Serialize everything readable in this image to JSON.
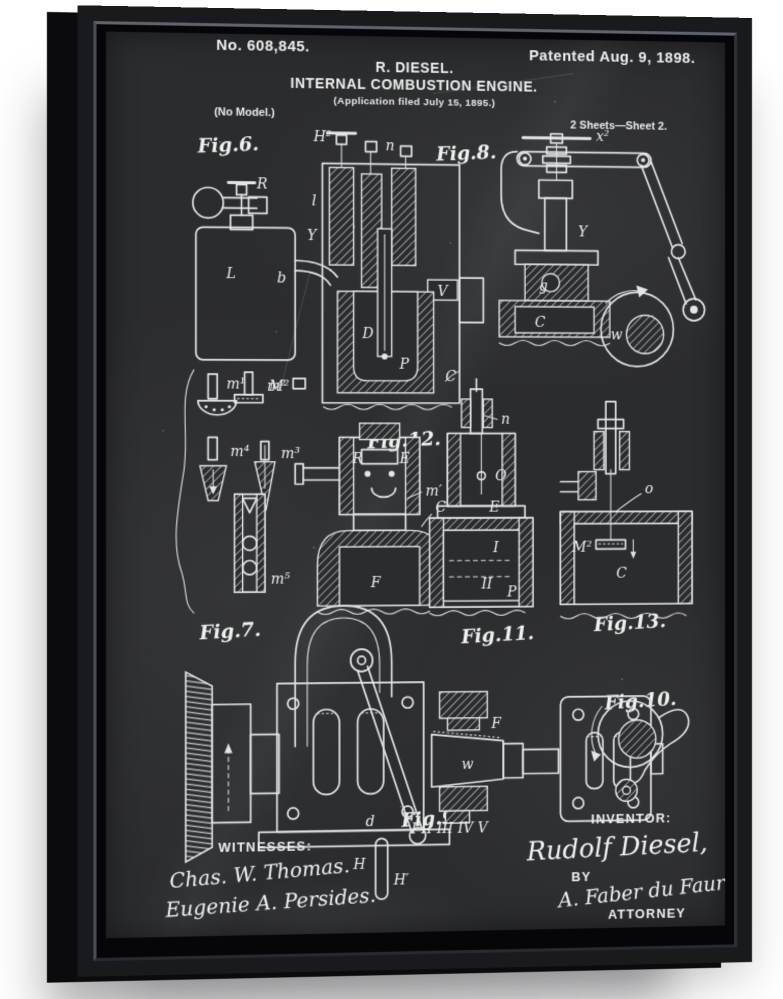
{
  "colors": {
    "background": "#ffffff",
    "frame": "#191a1e",
    "frame_side": "#0b0b0d",
    "chalkboard": "#2b2c2e",
    "chalk": "#e8eaea"
  },
  "patent": {
    "number": "No. 608,845.",
    "date": "Patented Aug. 9, 1898.",
    "inventor_name": "R. DIESEL.",
    "title": "INTERNAL COMBUSTION ENGINE.",
    "application": "(Application filed July 15, 1895.)",
    "model_note": "(No Model.)",
    "sheet_note": "2 Sheets—Sheet 2.",
    "figures": {
      "fig6": {
        "label": "Fig.6.",
        "parts": {
          "R": "R",
          "L": "L",
          "b": "b",
          "S": "S",
          "l": "l",
          "H2": "H²",
          "n": "n",
          "Y": "Y",
          "V": "V",
          "D": "D",
          "P": "P",
          "C": "C",
          "M2": "M²"
        }
      },
      "fig8": {
        "label": "Fig.8.",
        "parts": {
          "x2": "x²",
          "Y": "Y",
          "g": "g",
          "C": "C",
          "w": "w"
        }
      },
      "fig7": {
        "label": "Fig.7.",
        "parts": {
          "m1": "m¹",
          "m2": "m²",
          "m3": "m³",
          "m4": "m⁴",
          "m5": "m⁵"
        }
      },
      "fig12": {
        "label": "Fig.12.",
        "parts": {
          "R": "R",
          "E": "E",
          "m_prime": "m′",
          "C": "C",
          "F": "F"
        }
      },
      "fig11": {
        "label": "Fig.11.",
        "parts": {
          "n": "n",
          "O": "O",
          "E": "E",
          "I": "I",
          "II": "II",
          "P": "P"
        }
      },
      "fig13": {
        "label": "Fig.13.",
        "parts": {
          "o": "o",
          "M2": "M²",
          "C": "C"
        }
      },
      "fig9": {
        "label": "Fig.9.",
        "parts": {
          "d": "d",
          "H": "H",
          "H_prime": "H′",
          "F": "F",
          "w": "w",
          "numerals": "I II III IV V"
        }
      },
      "fig10": {
        "label": "Fig.10."
      }
    },
    "witnesses": {
      "heading": "WITNESSES:",
      "signatures": [
        "Chas. W. Thomas.",
        "Eugenie A. Persides."
      ]
    },
    "inventor": {
      "heading": "INVENTOR:",
      "name": "Rudolf Diesel,",
      "by_label": "BY",
      "attorney_signature": "A. Faber du Faur",
      "attorney_label": "ATTORNEY"
    }
  }
}
